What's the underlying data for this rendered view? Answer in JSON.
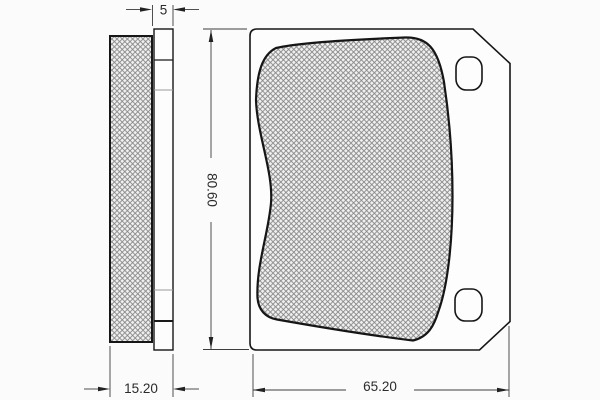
{
  "drawing": {
    "kind": "brake pad technical drawing, side profile and front view with dimensions",
    "views": {
      "side": {
        "dims": {
          "plate_thickness": {
            "label": "5"
          },
          "total_thickness": {
            "label": "15.20"
          }
        }
      },
      "front": {
        "dims": {
          "height": {
            "label": "80.60"
          },
          "width": {
            "label": "65.20"
          }
        }
      }
    },
    "colors": {
      "background": "#fbfbfb",
      "outline": "#161616",
      "hatch_line": "#858585",
      "hatch_bg": "#f1f1f1",
      "dimension_line": "#3c3c3c",
      "text": "#2b2b2b"
    }
  }
}
